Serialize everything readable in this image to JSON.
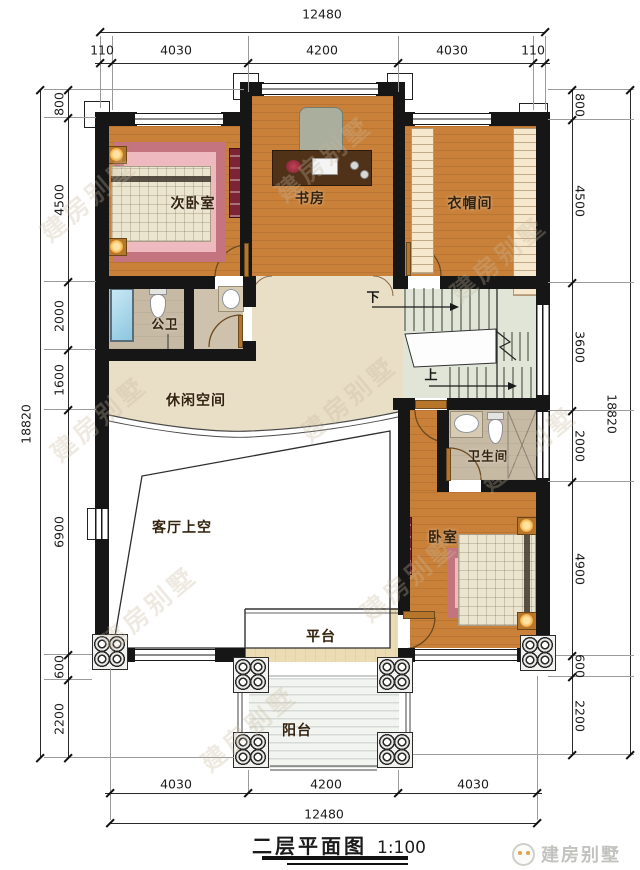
{
  "title": {
    "text": "二层平面图",
    "scale": "1:100"
  },
  "brand": {
    "name": "建房别墅"
  },
  "watermark": {
    "text": "建房别墅"
  },
  "rooms": {
    "secondary_bedroom": "次卧室",
    "study": "书房",
    "cloakroom": "衣帽间",
    "public_bath": "公卫",
    "leisure": "休闲空间",
    "living_void": "客厅上空",
    "bathroom": "卫生间",
    "bedroom": "卧室",
    "platform": "平台",
    "balcony": "阳台"
  },
  "stairs": {
    "down": "下",
    "up": "上"
  },
  "dims": {
    "top": {
      "overall": "12480",
      "segments": [
        "110",
        "4030",
        "4200",
        "4030",
        "110"
      ]
    },
    "bottom": {
      "overall": "12480",
      "segments": [
        "4030",
        "4200",
        "4030"
      ]
    },
    "left": {
      "overall": "18820",
      "segments": [
        "800",
        "4500",
        "2000",
        "1600",
        "6900",
        "600",
        "2200"
      ]
    },
    "right": {
      "overall": "18820",
      "segments": [
        "800",
        "4500",
        "3600",
        "2000",
        "4900",
        "600",
        "2200"
      ]
    }
  },
  "colors": {
    "wall": "#161616",
    "floor_wood": "#c9813a",
    "floor_hall": "#e9dfc6",
    "floor_bath": "#c7baa5",
    "floor_stairs": "#e0e5d8",
    "rug": "#c4747f",
    "lamp_glow": "#f2a93b",
    "cabinet": "#7c2433"
  }
}
